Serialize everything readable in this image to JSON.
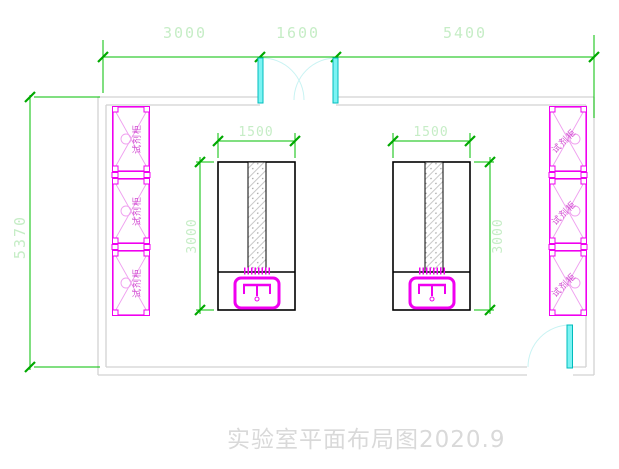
{
  "title": "实验室平面布局图2020.9",
  "dimensions": {
    "top_left": "3000",
    "top_middle": "1600",
    "top_right": "5400",
    "left_wall": "5370",
    "left_table_width": "1500",
    "left_table_depth": "3000",
    "right_table_width": "1500",
    "right_table_depth": "3000"
  },
  "cabinets": {
    "left": [
      "试剂柜",
      "试剂柜",
      "试剂柜"
    ],
    "right": [
      "试剂柜",
      "试剂柜",
      "试剂柜"
    ]
  },
  "colors": {
    "dimension_line": "#00bf00",
    "dimension_text": "#c6edc6",
    "cabinet": "#f000f0",
    "door": "#31e3e3",
    "wall": "#d2d2d2",
    "table_outline": "#000000",
    "title_text": "#d9d9d9"
  }
}
